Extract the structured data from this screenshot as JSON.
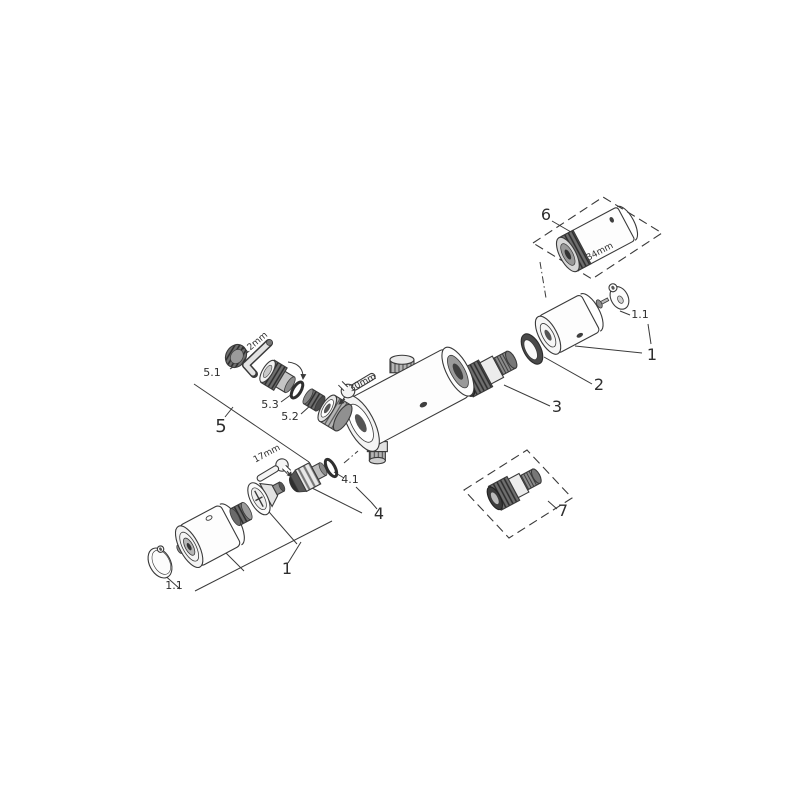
{
  "diagram": {
    "background": "#ffffff",
    "line_color": "#3a3a3a",
    "text_color": "#2e2e2e",
    "labels": [
      {
        "id": "part-6",
        "text": "6",
        "x": 546,
        "y": 220,
        "size": 16
      },
      {
        "id": "dim-34mm",
        "text": "34mm",
        "x": 601,
        "y": 254,
        "size": 9,
        "rotate": -28
      },
      {
        "id": "part-1-1-right",
        "text": "1.1",
        "x": 640,
        "y": 318,
        "size": 11
      },
      {
        "id": "part-1-right",
        "text": "1",
        "x": 652,
        "y": 360,
        "size": 16
      },
      {
        "id": "part-2",
        "text": "2",
        "x": 599,
        "y": 390,
        "size": 16
      },
      {
        "id": "part-3",
        "text": "3",
        "x": 557,
        "y": 412,
        "size": 16
      },
      {
        "id": "part-5-1",
        "text": "5.1",
        "x": 212,
        "y": 376,
        "size": 11
      },
      {
        "id": "dim-12mm",
        "text": "12mm",
        "x": 257,
        "y": 345,
        "size": 9,
        "rotate": -40
      },
      {
        "id": "part-5-3",
        "text": "5.3",
        "x": 270,
        "y": 408,
        "size": 11
      },
      {
        "id": "part-5-2",
        "text": "5.2",
        "x": 290,
        "y": 420,
        "size": 11
      },
      {
        "id": "part-5",
        "text": "5",
        "x": 221,
        "y": 432,
        "size": 18
      },
      {
        "id": "dim-30mm",
        "text": "30mm",
        "x": 364,
        "y": 385,
        "size": 9,
        "rotate": -28
      },
      {
        "id": "dim-17mm",
        "text": "17mm",
        "x": 268,
        "y": 456,
        "size": 9,
        "rotate": -28
      },
      {
        "id": "part-4-1",
        "text": "4.1",
        "x": 350,
        "y": 483,
        "size": 11
      },
      {
        "id": "part-4",
        "text": "4",
        "x": 379,
        "y": 519,
        "size": 16
      },
      {
        "id": "part-1-1-left",
        "text": "1.1",
        "x": 174,
        "y": 589,
        "size": 11
      },
      {
        "id": "part-1-left",
        "text": "1",
        "x": 287,
        "y": 574,
        "size": 16
      },
      {
        "id": "part-7",
        "text": "7",
        "x": 563,
        "y": 516,
        "size": 16
      }
    ]
  }
}
